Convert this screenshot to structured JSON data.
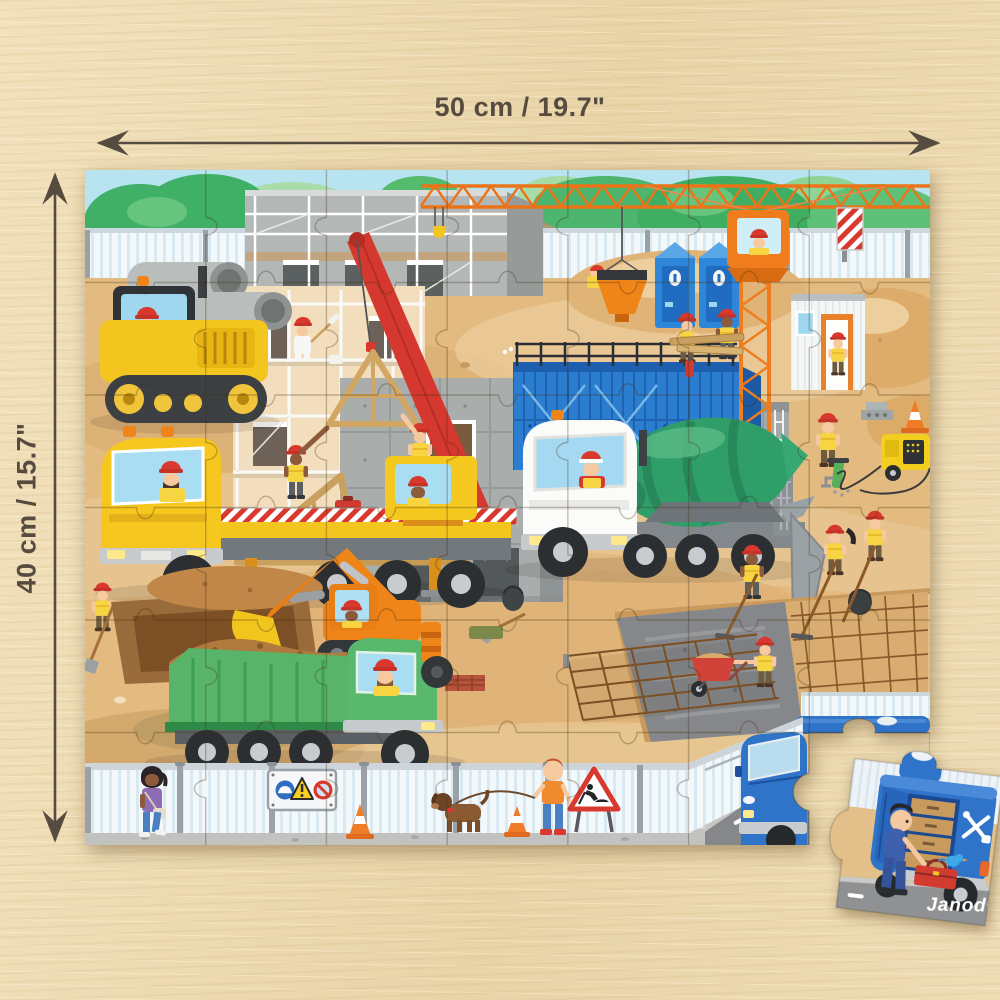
{
  "product": {
    "brand_logo": "Janod®",
    "subject": "Construction site children's jigsaw puzzle lying on a wooden table"
  },
  "measurements": {
    "width_label": "50 cm / 19.7\"",
    "height_label": "40 cm / 15.7\""
  },
  "puzzle": {
    "grid_cols": 7,
    "grid_rows": 6,
    "missing_piece": "bottom-right corner piece detached and lying next to the puzzle",
    "loose_piece_subject": "mechanic pulling a red toolbox from a blue service van"
  },
  "scene": {
    "elements": [
      "trees",
      "site-fence",
      "tower-crane",
      "crane-operator",
      "scaffolded-building",
      "painter",
      "concrete-building",
      "blue-formwork",
      "roof-truss",
      "mobile-crane-truck",
      "bulldozer",
      "concrete-pipes",
      "portable-toilets",
      "site-office",
      "cement-mixer-truck",
      "concrete-slab-with-rebar",
      "jackhammer-worker",
      "generator",
      "excavator",
      "dump-truck",
      "road-roller",
      "rebar-mesh",
      "wheelbarrow-worker",
      "warning-sign-board",
      "road-work-sign",
      "traffic-cones",
      "pedestrian-woman",
      "boy-with-dog",
      "blue-van"
    ]
  },
  "signage": {
    "board_icons": [
      "helmet-mandatory-icon",
      "warning-triangle-icon",
      "no-entry-icon"
    ],
    "roadwork_sign": "men-at-work-icon"
  },
  "colors": {
    "wood": "#ecdab3",
    "annotation": "#554b3f",
    "sky": "#b8e3f1",
    "sand": "#e3ba80",
    "crane_orange": "#ef7d1d",
    "helmet_red": "#d8382e",
    "vest_yellow": "#f7d441",
    "van_blue": "#2f74c9",
    "mixer_green": "#2f9e68",
    "truck_green": "#57b469",
    "machine_yellow": "#f2c51f",
    "machine_orange": "#ef8519"
  }
}
